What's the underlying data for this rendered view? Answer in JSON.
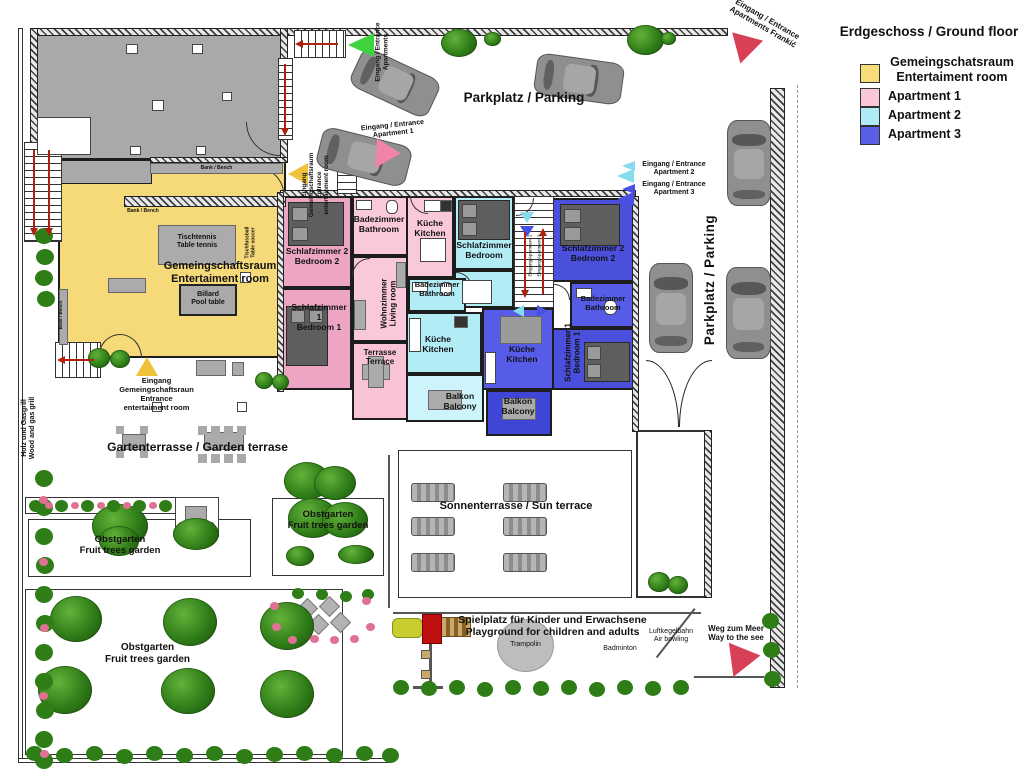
{
  "legend": {
    "title": "Erdgeschoss / Ground floor",
    "entertainment": {
      "label": "Gemeingschatsraum\nEntertaiment room",
      "color": "#F8DC7A"
    },
    "apartment1": {
      "label": "Apartment 1",
      "color": "#F9C6DA"
    },
    "apartment2": {
      "label": "Apartment 2",
      "color": "#AEEBF5"
    },
    "apartment3": {
      "label": "Apartment 3",
      "color": "#5A5FE8"
    }
  },
  "parking": {
    "top_label": "Parkplatz / Parking",
    "right_label": "Parkplatz / Parking"
  },
  "entrances": {
    "apartments_top": "Eingang / Entrance\nApartments",
    "apartment1": "Eingang / Entrance\nApartment 1",
    "apartment2": "Eingang / Entrance\nApartment 2",
    "apartment3": "Eingang / Entrance\nApartment 3",
    "frankic": "Eingang / Entrance\nApartments Frankić",
    "entertainment_side": "Eingang\nGemeingschaftsraum\nEntrance\nentertainment room",
    "entertainment_garden": "Eingang\nGemeingschaftsraun\nEntrance\nentertaiment room",
    "stairs_apartment2": "Eingang Apartment 2",
    "stairs_apartment3": "Eingang Apartment 3"
  },
  "entertainment_room": {
    "name": "Gemeingschaftsraum\nEntertaiment room",
    "table_tennis": "Tischtennis\nTable tennis",
    "pool_table": "Billard\nPool table",
    "table_soccer": "Tischfussball\nTable soccer",
    "bench": "Bank / Bench"
  },
  "apartment1": {
    "bedroom2": "Schlafzimmer 2\nBedroom 2",
    "bedroom1": "Schlafzimmer 1\nBedroom 1",
    "bathroom": "Badezimmer\nBathroom",
    "kitchen": "Küche\nKitchen",
    "living_room": "Wohnzimmer\nLiving room",
    "terrace": "Terrasse\nTerrace"
  },
  "apartment2": {
    "bedroom": "Schlafzimmer\nBedroom",
    "bathroom": "Badezimmer\nBathroom",
    "kitchen": "Küche\nKitchen",
    "balcony": "Balkon\nBalcony"
  },
  "apartment3": {
    "bedroom2": "Schlafzimmer 2\nBedroom 2",
    "bedroom1": "Schlafzimmer 1\nBedroom 1",
    "bathroom": "Badezimmer\nBathroom",
    "kitchen": "Küche\nKitchen",
    "balcony": "Balkon\nBalcony"
  },
  "garden": {
    "garden_terrace": "Gartenterrasse / Garden terrase",
    "sun_terrace": "Sonnenterrasse / Sun terrace",
    "orchard": "Obstgarten\nFruit trees garden",
    "grill": "Holz und Gasgrill\nWood and gas grill",
    "way_to_sea": "Weg zum Meer\nWay to the see"
  },
  "playground": {
    "title": "Spielplatz für  Kinder und Erwachsene\nPlayground for children and adults",
    "trampoline": "Trampolin",
    "badminton": "Badminton",
    "air_bowling": "Luftkegelbahn\nAir bowling"
  }
}
